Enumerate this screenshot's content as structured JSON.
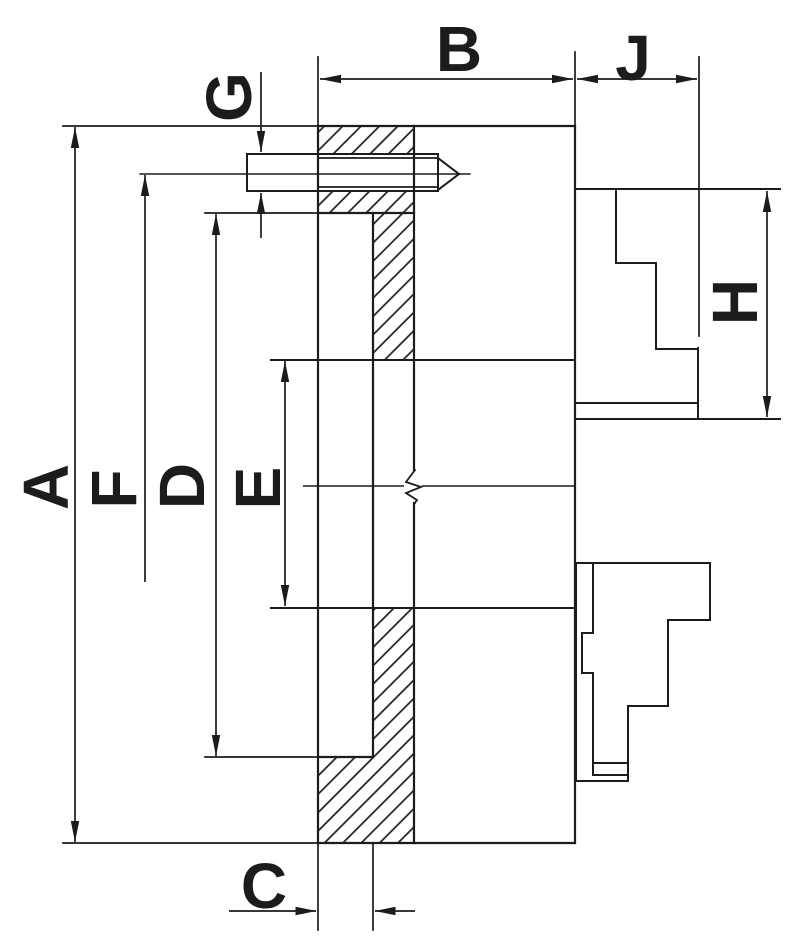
{
  "drawing": {
    "background_color": "#ffffff",
    "line_color": "#1c1c1c",
    "dimension_labels": {
      "A": "A",
      "B": "B",
      "C": "C",
      "D": "D",
      "E": "E",
      "F": "F",
      "G": "G",
      "H": "H",
      "J": "J"
    }
  }
}
